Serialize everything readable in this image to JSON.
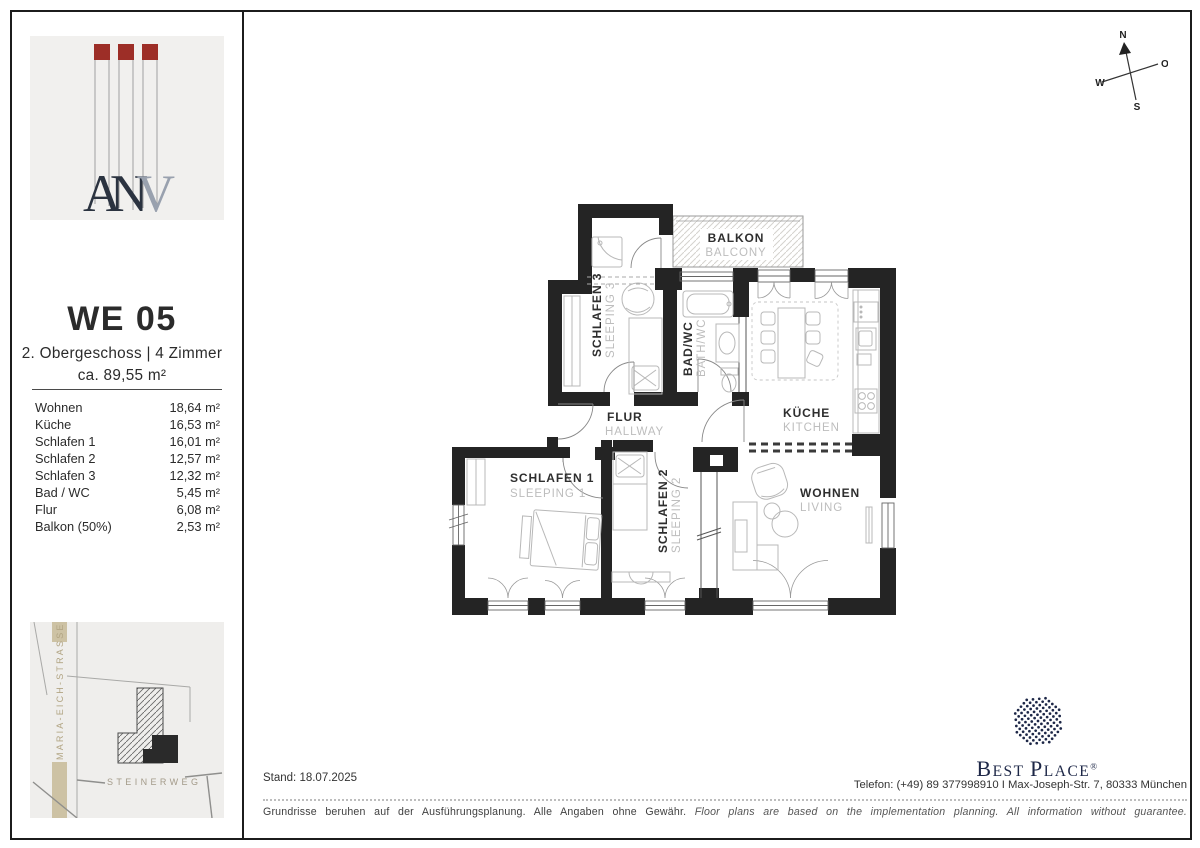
{
  "sidebar": {
    "logo": {
      "dark": "AN",
      "light": "V",
      "square_color": "#9d2e27"
    },
    "unit": {
      "title": "WE 05",
      "floor": "2. Obergeschoss | 4 Zimmer",
      "area": "ca. 89,55 m²"
    },
    "rooms": [
      {
        "label": "Wohnen",
        "value": "18,64 m²"
      },
      {
        "label": "Küche",
        "value": "16,53 m²"
      },
      {
        "label": "Schlafen 1",
        "value": "16,01 m²"
      },
      {
        "label": "Schlafen 2",
        "value": "12,57 m²"
      },
      {
        "label": "Schlafen 3",
        "value": "12,32 m²"
      },
      {
        "label": "Bad / WC",
        "value": "5,45 m²"
      },
      {
        "label": "Flur",
        "value": "6,08 m²"
      },
      {
        "label": "Balkon (50%)",
        "value": "2,53 m²"
      }
    ],
    "map": {
      "street_v": "MARIA-EICH-STRASSE",
      "street_h": "STEINERWEG"
    }
  },
  "plan": {
    "balkon": {
      "de": "BALKON",
      "en": "BALCONY"
    },
    "schlafen3": {
      "de": "SCHLAFEN 3",
      "en": "SLEEPING 3"
    },
    "bad": {
      "de": "BAD/WC",
      "en": "BATH/WC"
    },
    "kueche": {
      "de": "KÜCHE",
      "en": "KITCHEN"
    },
    "flur": {
      "de": "FLUR",
      "en": "HALLWAY"
    },
    "schlafen1": {
      "de": "SCHLAFEN 1",
      "en": "SLEEPING 1"
    },
    "schlafen2": {
      "de": "SCHLAFEN 2",
      "en": "SLEEPING 2"
    },
    "wohnen": {
      "de": "WOHNEN",
      "en": "LIVING"
    }
  },
  "compass": {
    "n": "N",
    "e": "O",
    "s": "S",
    "w": "W"
  },
  "footer": {
    "stand": "Stand: 18.07.2025",
    "contact": "Telefon: (+49) 89 377998910 I Max-Joseph-Str. 7, 80333 München",
    "disclaimer_de": "Grundrisse beruhen auf der Ausführungsplanung. Alle Angaben ohne Gewähr.",
    "disclaimer_en": "Floor plans are based on the implementation planning. All information without guarantee."
  },
  "brand": {
    "b1": "B",
    "rest1": "EST",
    "b2": "P",
    "rest2": "LACE",
    "reg": "®",
    "color": "#1d2747"
  }
}
